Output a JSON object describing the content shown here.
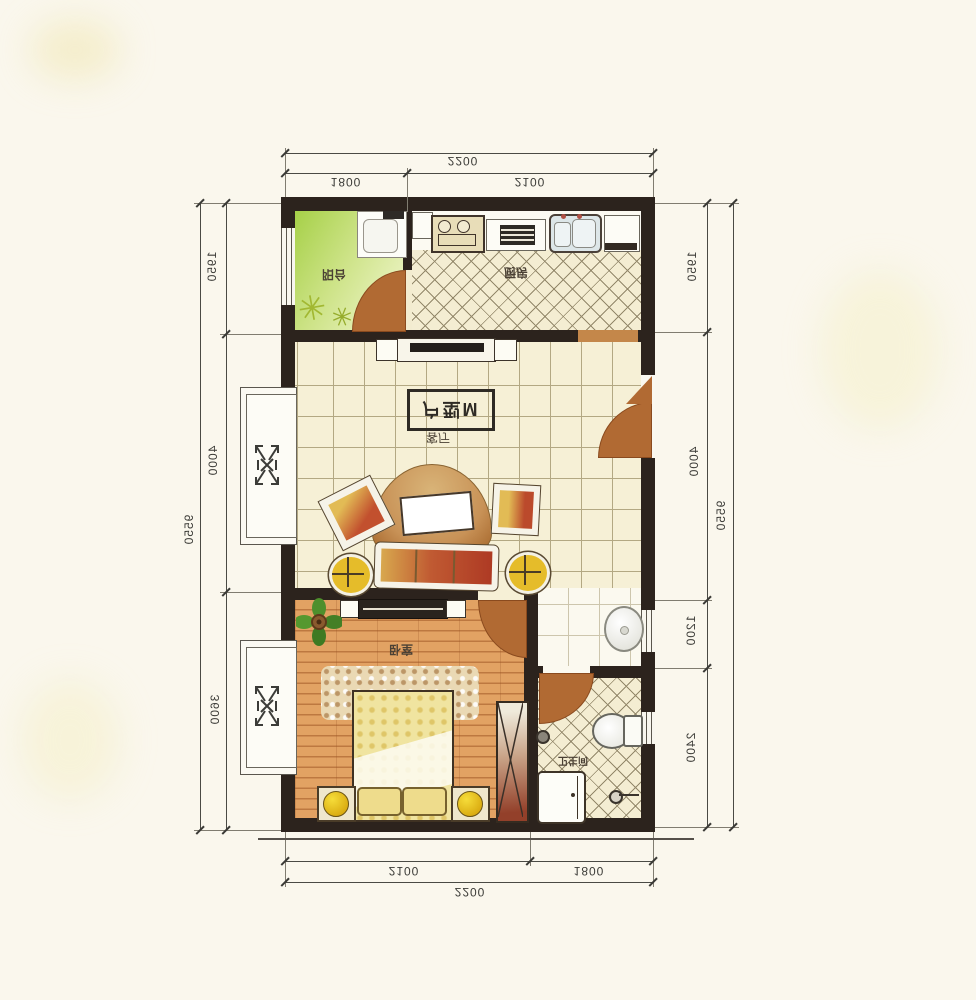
{
  "title_box": {
    "label": "户型M"
  },
  "rooms": {
    "balcony": "阳台",
    "kitchen": "厨房",
    "living": "客厅",
    "bedroom": "卧室",
    "bathroom": "卫生间"
  },
  "dimensions": {
    "top": {
      "total": "2200",
      "segments": [
        "1800",
        "2100"
      ]
    },
    "bottom": {
      "total": "2200",
      "segments": [
        "2100",
        "1800"
      ]
    },
    "left": {
      "total": "9550",
      "segments": [
        "1950",
        "4000",
        "3600"
      ]
    },
    "right": {
      "total": "9550",
      "segments": [
        "1950",
        "4000",
        "1200",
        "2400"
      ]
    }
  },
  "icons": {
    "plant_glyph": "✳"
  },
  "colors": {
    "wall": "#2c231d",
    "door": "#b16a33",
    "balcony_green": "#a6d048",
    "wood_floor": "#dd9c5e",
    "tile_cream": "#f4edd2",
    "cushion_red": "#b03a26",
    "cushion_yellow": "#e2bb55",
    "lamp_yellow": "#e8c412",
    "paper": "#faf7ed"
  }
}
